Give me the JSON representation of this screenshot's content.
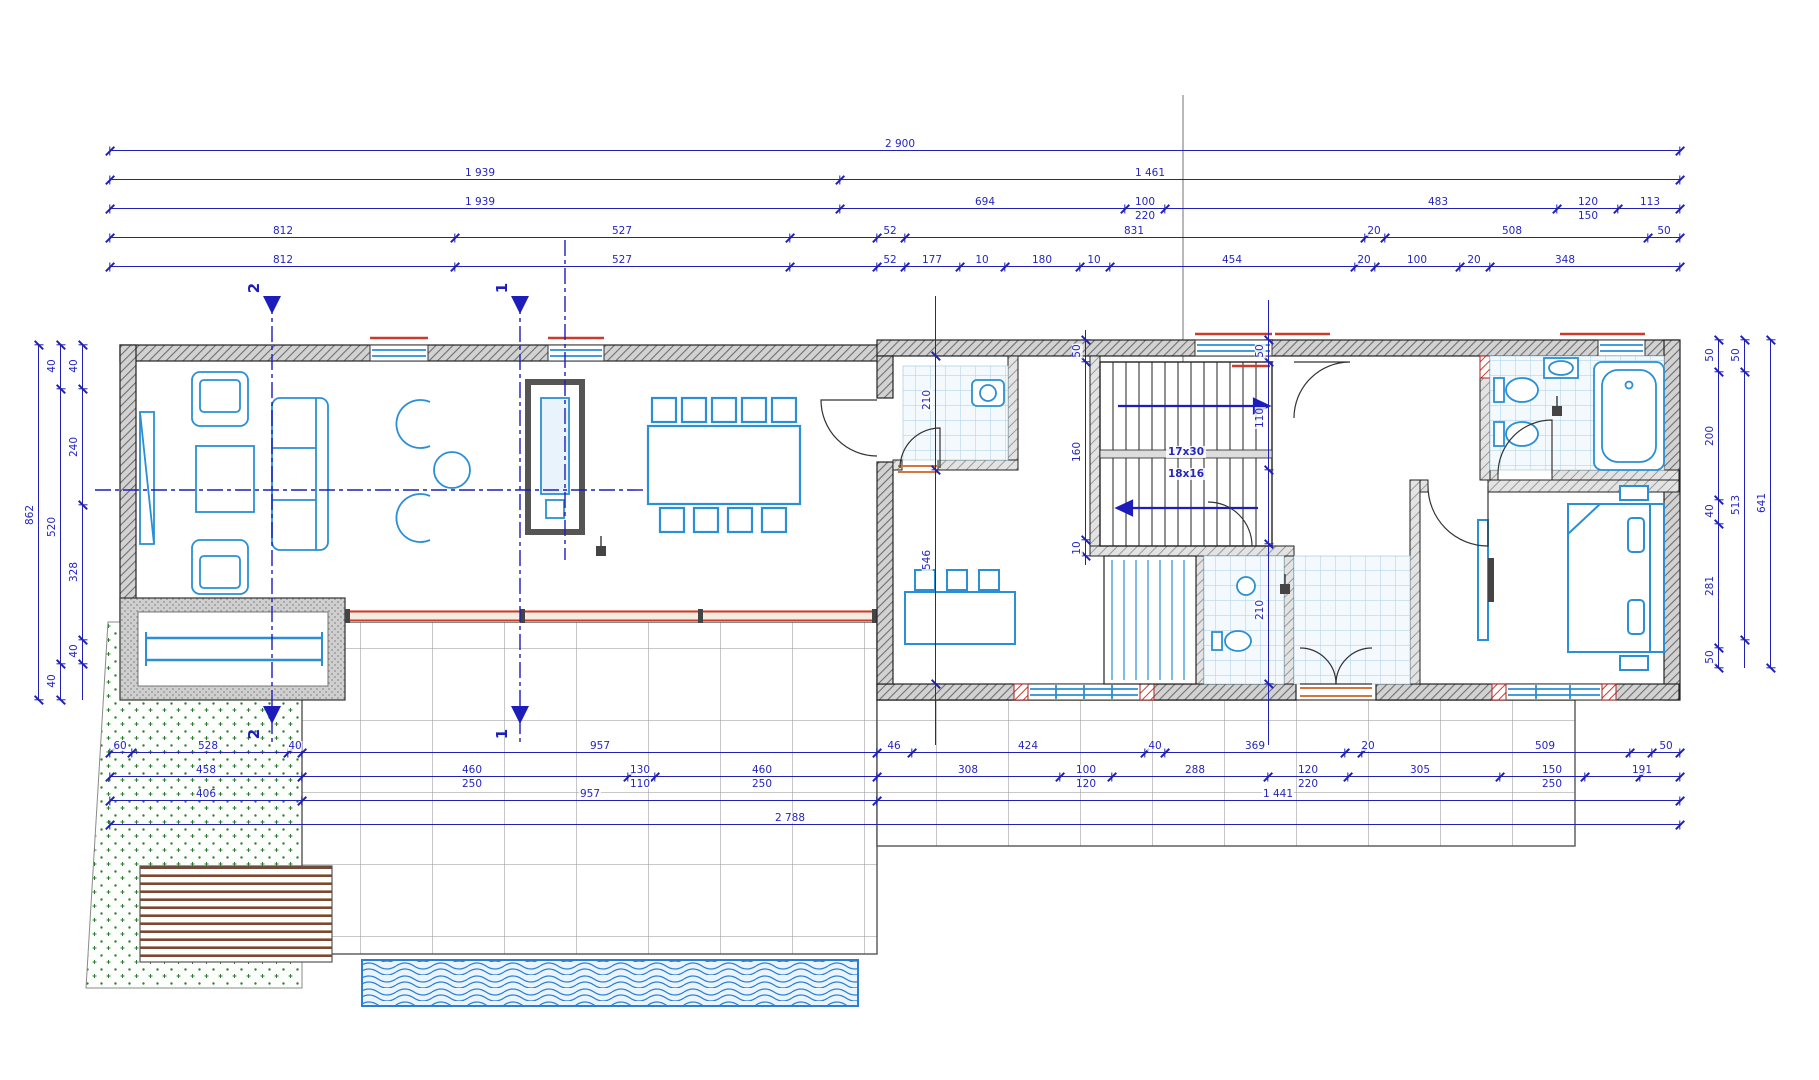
{
  "title": "Ground floor plan with dimension chains",
  "colors": {
    "dimension_blue": "#2020b4",
    "furniture_blue": "#2a8fd4",
    "wall_hatch_gray": "#9a9a9a",
    "accent_red": "#cc3b2a",
    "threshold_orange": "#d4763b",
    "grass_green": "#2e7d32",
    "deck_brown": "#7b4a2e",
    "pool_blue": "#2a7fd4",
    "terrace_grid_gray": "#a8a8a8",
    "axis_gray": "#8a8a8a"
  },
  "stairs": {
    "line1": "17x30",
    "line2": "18x16"
  },
  "sections": [
    {
      "label": "2"
    },
    {
      "label": "1"
    }
  ],
  "dims": {
    "h": [
      {
        "y": 150,
        "x1": 110,
        "x2": 1680,
        "ticks": [
          110,
          1680
        ],
        "labels": [
          {
            "t": "2 900",
            "x": 900
          }
        ]
      },
      {
        "y": 179,
        "x1": 110,
        "x2": 1680,
        "ticks": [
          110,
          840,
          1680
        ],
        "labels": [
          {
            "t": "1 939",
            "x": 480
          },
          {
            "t": "1 461",
            "x": 1150
          }
        ]
      },
      {
        "y": 208,
        "x1": 110,
        "x2": 1680,
        "ticks": [
          110,
          840,
          1125,
          1165,
          1557,
          1618,
          1680
        ],
        "labels": [
          {
            "t": "1 939",
            "x": 480
          },
          {
            "t": "694",
            "x": 985
          },
          {
            "t": "100",
            "x": 1145
          },
          {
            "t": "220",
            "x": 1145,
            "pos": "below"
          },
          {
            "t": "483",
            "x": 1438
          },
          {
            "t": "120",
            "x": 1588
          },
          {
            "t": "150",
            "x": 1588,
            "pos": "below"
          },
          {
            "t": "113",
            "x": 1650
          }
        ]
      },
      {
        "y": 237,
        "x1": 110,
        "x2": 1680,
        "ticks": [
          110,
          455,
          790,
          877,
          905,
          1365,
          1385,
          1648,
          1680
        ],
        "labels": [
          {
            "t": "812",
            "x": 283
          },
          {
            "t": "527",
            "x": 622
          },
          {
            "t": "52",
            "x": 890
          },
          {
            "t": "831",
            "x": 1134
          },
          {
            "t": "20",
            "x": 1374
          },
          {
            "t": "508",
            "x": 1512
          },
          {
            "t": "50",
            "x": 1664
          }
        ]
      },
      {
        "y": 266,
        "x1": 110,
        "x2": 1680,
        "ticks": [
          110,
          455,
          790,
          877,
          905,
          960,
          1005,
          1080,
          1110,
          1355,
          1375,
          1460,
          1490,
          1680
        ],
        "labels": [
          {
            "t": "812",
            "x": 283
          },
          {
            "t": "527",
            "x": 622
          },
          {
            "t": "52",
            "x": 890
          },
          {
            "t": "177",
            "x": 932
          },
          {
            "t": "10",
            "x": 982
          },
          {
            "t": "180",
            "x": 1042
          },
          {
            "t": "10",
            "x": 1094
          },
          {
            "t": "454",
            "x": 1232
          },
          {
            "t": "20",
            "x": 1364
          },
          {
            "t": "100",
            "x": 1417
          },
          {
            "t": "20",
            "x": 1474
          },
          {
            "t": "348",
            "x": 1565
          }
        ]
      },
      {
        "y": 752,
        "x1": 110,
        "x2": 1680,
        "ticks": [
          110,
          132,
          288,
          302,
          877,
          912,
          1145,
          1165,
          1345,
          1362,
          1630,
          1652,
          1680
        ],
        "labels": [
          {
            "t": "60",
            "x": 120
          },
          {
            "t": "528",
            "x": 208
          },
          {
            "t": "40",
            "x": 295
          },
          {
            "t": "957",
            "x": 600
          },
          {
            "t": "46",
            "x": 894
          },
          {
            "t": "424",
            "x": 1028
          },
          {
            "t": "40",
            "x": 1155
          },
          {
            "t": "369",
            "x": 1255
          },
          {
            "t": "20",
            "x": 1368
          },
          {
            "t": "509",
            "x": 1545
          },
          {
            "t": "50",
            "x": 1666
          }
        ]
      },
      {
        "y": 776,
        "x1": 110,
        "x2": 1680,
        "ticks": [
          110,
          302,
          628,
          655,
          877,
          1060,
          1112,
          1268,
          1348,
          1500,
          1585,
          1640,
          1680
        ],
        "labels": [
          {
            "t": "458",
            "x": 206
          },
          {
            "t": "460",
            "x": 472
          },
          {
            "t": "250",
            "x": 472,
            "pos": "below"
          },
          {
            "t": "130",
            "x": 640
          },
          {
            "t": "110",
            "x": 640,
            "pos": "below"
          },
          {
            "t": "460",
            "x": 762
          },
          {
            "t": "250",
            "x": 762,
            "pos": "below"
          },
          {
            "t": "308",
            "x": 968
          },
          {
            "t": "100",
            "x": 1086
          },
          {
            "t": "120",
            "x": 1086,
            "pos": "below"
          },
          {
            "t": "288",
            "x": 1195
          },
          {
            "t": "120",
            "x": 1308
          },
          {
            "t": "220",
            "x": 1308,
            "pos": "below"
          },
          {
            "t": "305",
            "x": 1420
          },
          {
            "t": "150",
            "x": 1552
          },
          {
            "t": "250",
            "x": 1552,
            "pos": "below"
          },
          {
            "t": "191",
            "x": 1642
          }
        ]
      },
      {
        "y": 800,
        "x1": 110,
        "x2": 1680,
        "ticks": [
          110,
          302,
          877,
          1680
        ],
        "labels": [
          {
            "t": "406",
            "x": 206
          },
          {
            "t": "957",
            "x": 590
          },
          {
            "t": "1 441",
            "x": 1278
          }
        ]
      },
      {
        "y": 824,
        "x1": 110,
        "x2": 1680,
        "ticks": [
          110,
          1680
        ],
        "labels": [
          {
            "t": "2 788",
            "x": 790
          }
        ]
      }
    ],
    "v": [
      {
        "x": 38,
        "y1": 345,
        "y2": 700,
        "ticks": [
          345,
          700
        ],
        "labels": [
          {
            "t": "862",
            "y": 515
          }
        ]
      },
      {
        "x": 60,
        "y1": 345,
        "y2": 700,
        "ticks": [
          345,
          389,
          664,
          700
        ],
        "labels": [
          {
            "t": "40",
            "y": 366
          },
          {
            "t": "520",
            "y": 527
          },
          {
            "t": "40",
            "y": 681
          }
        ]
      },
      {
        "x": 82,
        "y1": 345,
        "y2": 700,
        "ticks": [
          345,
          389,
          505,
          640,
          664
        ],
        "labels": [
          {
            "t": "40",
            "y": 366
          },
          {
            "t": "240",
            "y": 447
          },
          {
            "t": "328",
            "y": 572
          },
          {
            "t": "40",
            "y": 651
          }
        ]
      },
      {
        "x": 1718,
        "y1": 340,
        "y2": 668,
        "ticks": [
          340,
          372,
          500,
          524,
          648,
          668
        ],
        "labels": [
          {
            "t": "50",
            "y": 355
          },
          {
            "t": "200",
            "y": 436
          },
          {
            "t": "40",
            "y": 511
          },
          {
            "t": "281",
            "y": 586
          },
          {
            "t": "50",
            "y": 657
          }
        ]
      },
      {
        "x": 1744,
        "y1": 340,
        "y2": 668,
        "ticks": [
          340,
          372,
          640
        ],
        "labels": [
          {
            "t": "50",
            "y": 355
          },
          {
            "t": "513",
            "y": 505
          }
        ]
      },
      {
        "x": 1770,
        "y1": 340,
        "y2": 668,
        "ticks": [
          340,
          668
        ],
        "labels": [
          {
            "t": "641",
            "y": 503
          }
        ]
      },
      {
        "x": 935,
        "y1": 296,
        "y2": 745,
        "ticks": [
          356,
          470,
          684
        ],
        "labels": [
          {
            "t": "210",
            "y": 400
          },
          {
            "t": "546",
            "y": 560
          }
        ]
      },
      {
        "x": 1085,
        "y1": 330,
        "y2": 565,
        "ticks": [
          340,
          362,
          540,
          556
        ],
        "labels": [
          {
            "t": "50",
            "y": 351
          },
          {
            "t": "160",
            "y": 452
          },
          {
            "t": "10",
            "y": 548
          }
        ]
      },
      {
        "x": 1268,
        "y1": 300,
        "y2": 745,
        "ticks": [
          340,
          362,
          470,
          544,
          684
        ],
        "labels": [
          {
            "t": "50",
            "y": 351
          },
          {
            "t": "110",
            "y": 418
          },
          {
            "t": "210",
            "y": 610
          }
        ]
      }
    ]
  }
}
